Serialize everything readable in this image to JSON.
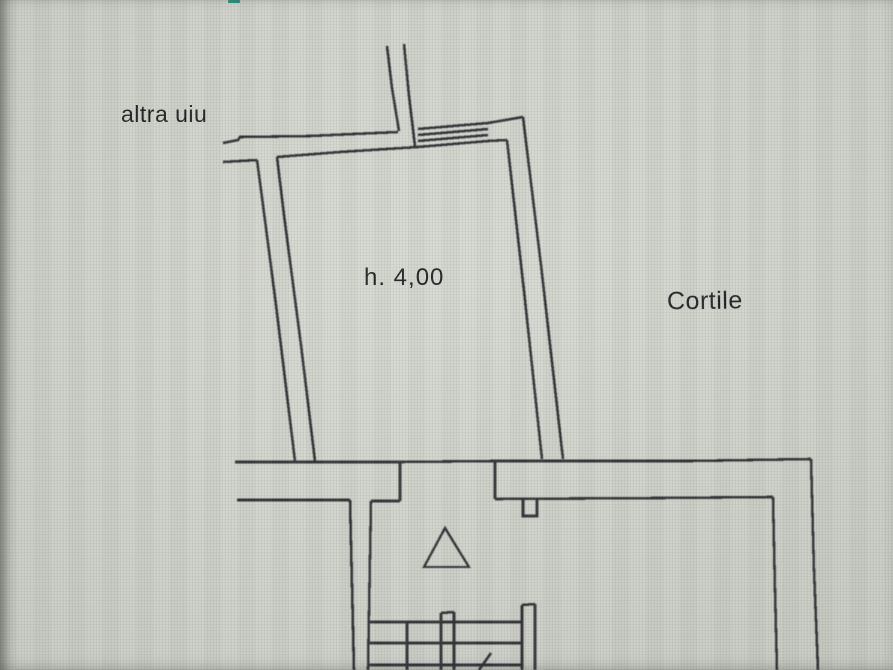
{
  "document": {
    "kind": "cadastral floor plan photographed on a screen"
  },
  "labels": {
    "altra_unit": {
      "text": "altra uiu"
    },
    "room_height": {
      "text": "h. 4,00"
    },
    "courtyard": {
      "text": "Cortile"
    }
  },
  "colors": {
    "background": "#d2d5cd",
    "line": "#2e2e33",
    "text": "#1e1e22",
    "screen_artifact": "#23907e"
  },
  "drawing": {
    "features": [
      "flue-walls-top",
      "upper-left-wall",
      "main-room-trapezoid",
      "window-hatch",
      "middle-double-wall-with-door-opening",
      "wall-notch-pier",
      "right-double-wall",
      "left-lower-double-wall",
      "staircase-treads",
      "stair-stringer",
      "stair-direction-triangle",
      "stair-arrow-line"
    ]
  }
}
